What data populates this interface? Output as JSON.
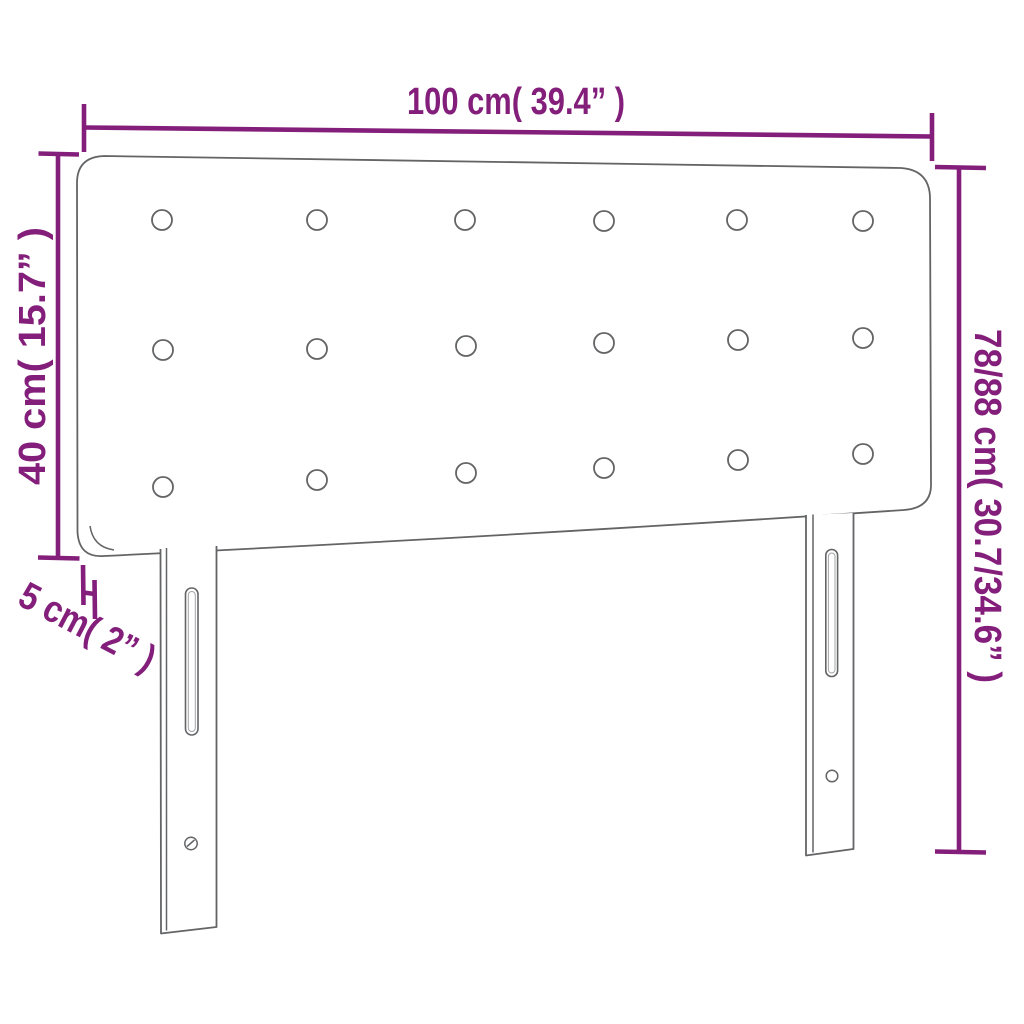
{
  "page": {
    "background": "#ffffff",
    "description": "Dimension diagram of an upholstered headboard with button tufting and two mounting legs"
  },
  "colors": {
    "accent": "#831f7b",
    "outline": "#636466"
  },
  "dimensions": {
    "width": {
      "label": "100 cm( 39.4” )",
      "cm": "100",
      "inches": "39.4"
    },
    "left_height": {
      "label": "40 cm( 15.7” )",
      "cm": "40",
      "inches": "15.7"
    },
    "right_height": {
      "label": "78/88 cm( 30.7/34.6” )",
      "cm": "78/88",
      "inches": "30.7/34.6"
    },
    "thickness": {
      "label": "5 cm( 2” )",
      "cm": "5",
      "inches": "2"
    }
  },
  "figure": {
    "buttons": {
      "rows": 3,
      "columns": 6,
      "total": 18
    },
    "legs": {
      "count": 2,
      "slots_per_leg": 1,
      "screw_holes_per_leg": 1
    }
  }
}
